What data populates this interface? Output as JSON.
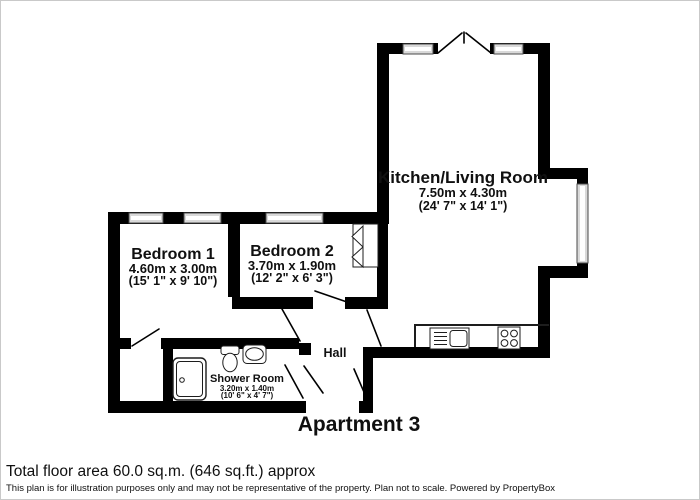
{
  "colors": {
    "wall": "#000000",
    "window-fill": "#d9d9d9",
    "window-stroke": "#4a4a4a",
    "text": "#101010"
  },
  "plan": {
    "title": "Apartment 3"
  },
  "rooms": {
    "kitchen": {
      "name": "Kitchen/Living Room",
      "metric": "7.50m x 4.30m",
      "imperial": "(24' 7\" x 14' 1\")"
    },
    "bedroom1": {
      "name": "Bedroom 1",
      "metric": "4.60m x 3.00m",
      "imperial": "(15' 1\" x 9' 10\")"
    },
    "bedroom2": {
      "name": "Bedroom 2",
      "metric": "3.70m x 1.90m",
      "imperial": "(12' 2\" x 6' 3\")"
    },
    "shower": {
      "name": "Shower Room",
      "metric": "3.20m x 1.40m",
      "imperial": "(10' 6\" x 4' 7\")"
    },
    "hall": {
      "name": "Hall"
    }
  },
  "footer": {
    "area": "Total floor area 60.0 sq.m. (646 sq.ft.) approx",
    "disclaimer": "This plan is for illustration purposes only and may not be representative of the property. Plan not to scale. Powered by PropertyBox"
  }
}
